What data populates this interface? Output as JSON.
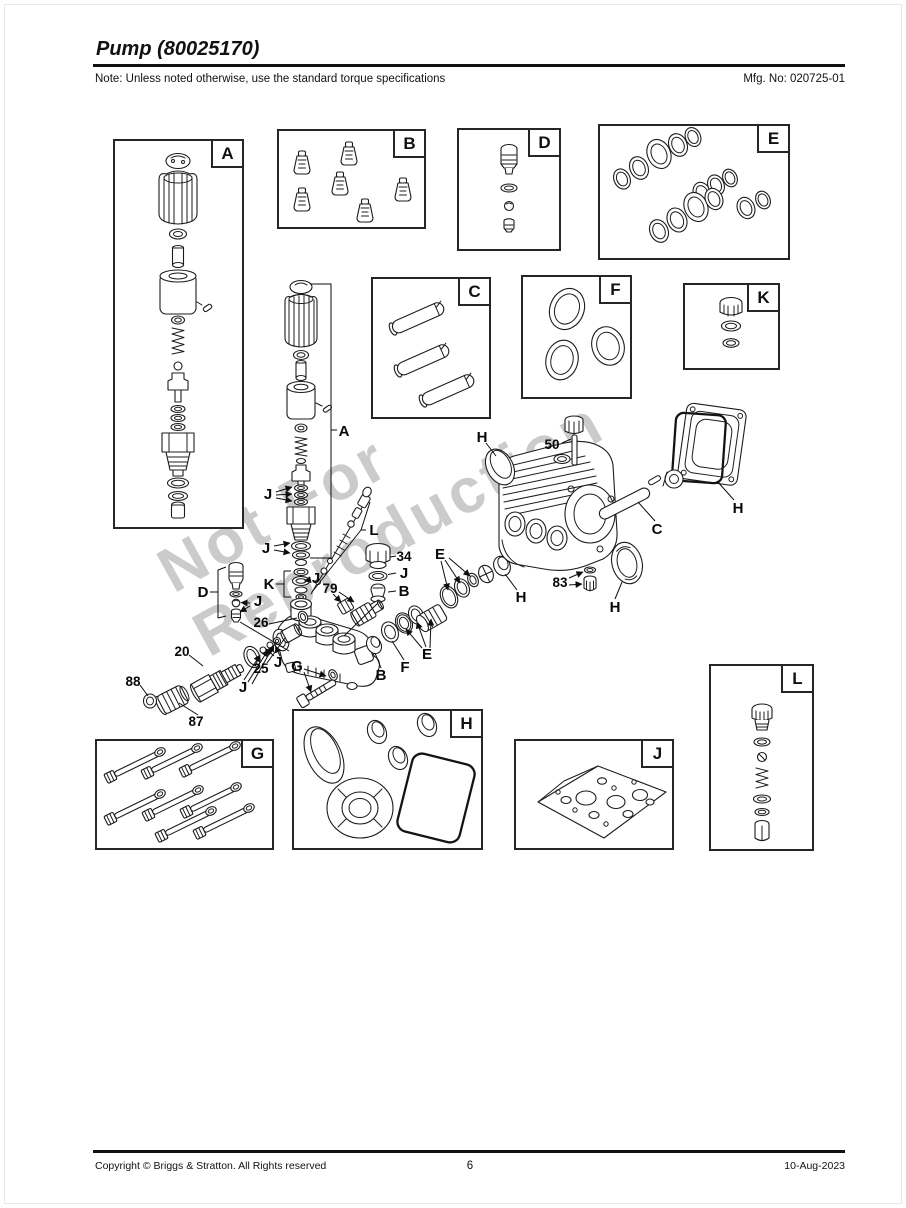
{
  "page": {
    "title": "Pump (80025170)",
    "note": "Note: Unless noted otherwise, use the standard torque specifications",
    "mfg_no": "Mfg. No: 020725-01",
    "footer_copyright": "Copyright ©  Briggs & Stratton. All Rights reserved",
    "page_number": "6",
    "date": "10-Aug-2023",
    "watermark": {
      "line1": "Not For",
      "line2": "Reproduction"
    }
  },
  "box_labels": {
    "A": "A",
    "B": "B",
    "C": "C",
    "D": "D",
    "E": "E",
    "F": "F",
    "G": "G",
    "H": "H",
    "J": "J",
    "K": "K",
    "L": "L"
  },
  "callouts": {
    "a_main": "A",
    "j_upper": "J",
    "j_mid": "J",
    "k_main": "K",
    "j_k": "J",
    "d_main": "D",
    "j_d": "J",
    "l_main": "L",
    "n34": "34",
    "j_34": "J",
    "b_34": "B",
    "n79": "79",
    "n26": "26",
    "n25": "25",
    "j_25": "J",
    "n20": "20",
    "j_20": "J",
    "n88": "88",
    "n87": "87",
    "g_main": "G",
    "b_chain": "B",
    "f_chain": "F",
    "e_lower": "E",
    "e_upper": "E",
    "h_oval": "H",
    "n50": "50",
    "c_rod": "C",
    "h_plate": "H",
    "h_seal": "H",
    "n83": "83",
    "h_cup": "H"
  }
}
